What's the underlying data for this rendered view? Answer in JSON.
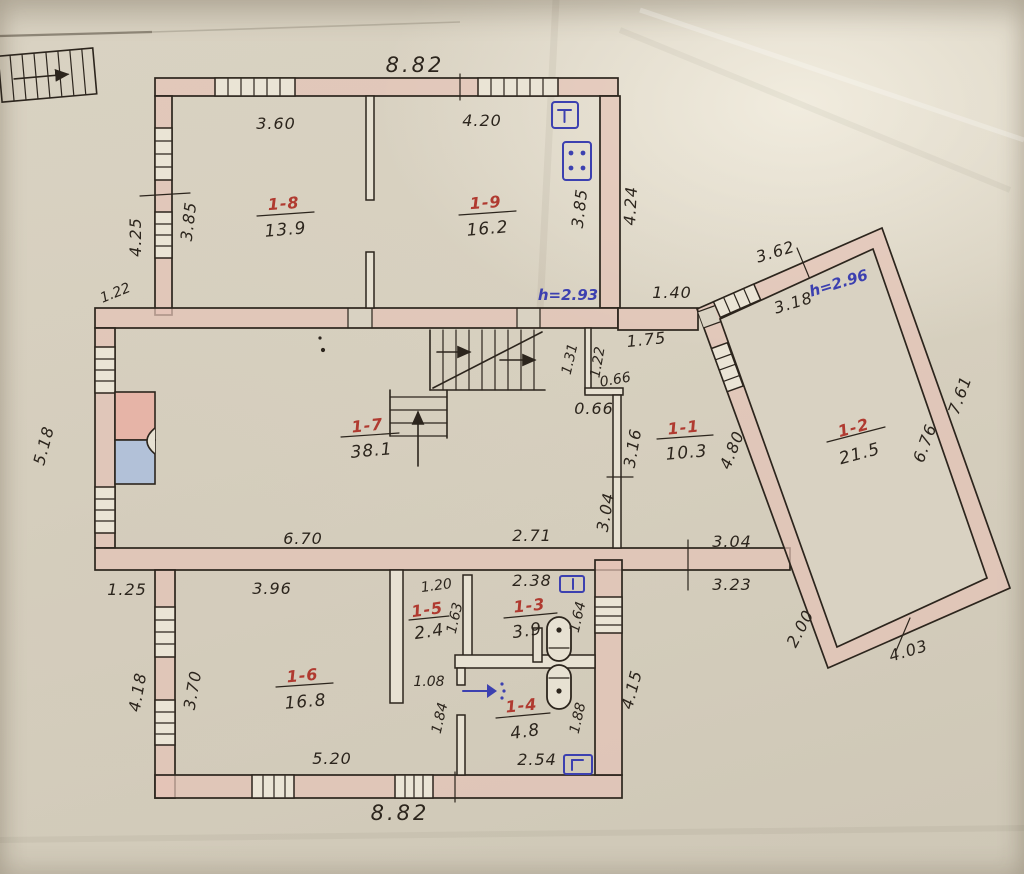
{
  "rooms": {
    "r1": {
      "num": "1-1",
      "area": "10.3"
    },
    "r2": {
      "num": "1-2",
      "area": "21.5"
    },
    "r3": {
      "num": "1-3",
      "area": "3.9"
    },
    "r4": {
      "num": "1-4",
      "area": "4.8"
    },
    "r5": {
      "num": "1-5",
      "area": "2.4"
    },
    "r6": {
      "num": "1-6",
      "area": "16.8"
    },
    "r7": {
      "num": "1-7",
      "area": "38.1"
    },
    "r8": {
      "num": "1-8",
      "area": "13.9"
    },
    "r9": {
      "num": "1-9",
      "area": "16.2"
    }
  },
  "heights": {
    "h_main": "h=2.93",
    "h_annex": "h=2.96"
  },
  "dims": {
    "top_total": "8.82",
    "r8_w": "3.60",
    "r9_w": "4.20",
    "left_out_v": "4.25",
    "r8_h": "3.85",
    "r9_h": "3.85",
    "right_out_v": "4.24",
    "left_jog": "1.22",
    "hall_gap": "1.40",
    "nook_top": "1.75",
    "nook_l": "1.31",
    "nook_r": "1.22",
    "nook_w1": "0.66",
    "nook_w2": "0.66",
    "hall_h1": "3.16",
    "hall_h2": "3.04",
    "r7_bot1": "6.70",
    "r7_bot2": "2.71",
    "left_mid_v": "5.18",
    "annex_top_out": "3.62",
    "annex_top_in": "3.18",
    "annex_right_out": "7.61",
    "annex_right_in": "6.76",
    "annex_left": "4.80",
    "hall_bot1": "3.04",
    "hall_bot2": "3.23",
    "annex_bl": "2.00",
    "annex_bottom": "4.03",
    "bot_left_jog": "1.25",
    "r6_w": "3.96",
    "r6_h": "3.70",
    "bot_left_out": "4.18",
    "r6_bot": "5.20",
    "bottom_total": "8.82",
    "r5_w": "1.20",
    "r5_h": "1.63",
    "r3_w": "2.38",
    "r3_h": "1.64",
    "corr_w": "1.08",
    "corr_h": "1.84",
    "r4_h": "1.88",
    "r4_bot": "2.54",
    "bot_right_v": "4.15"
  }
}
